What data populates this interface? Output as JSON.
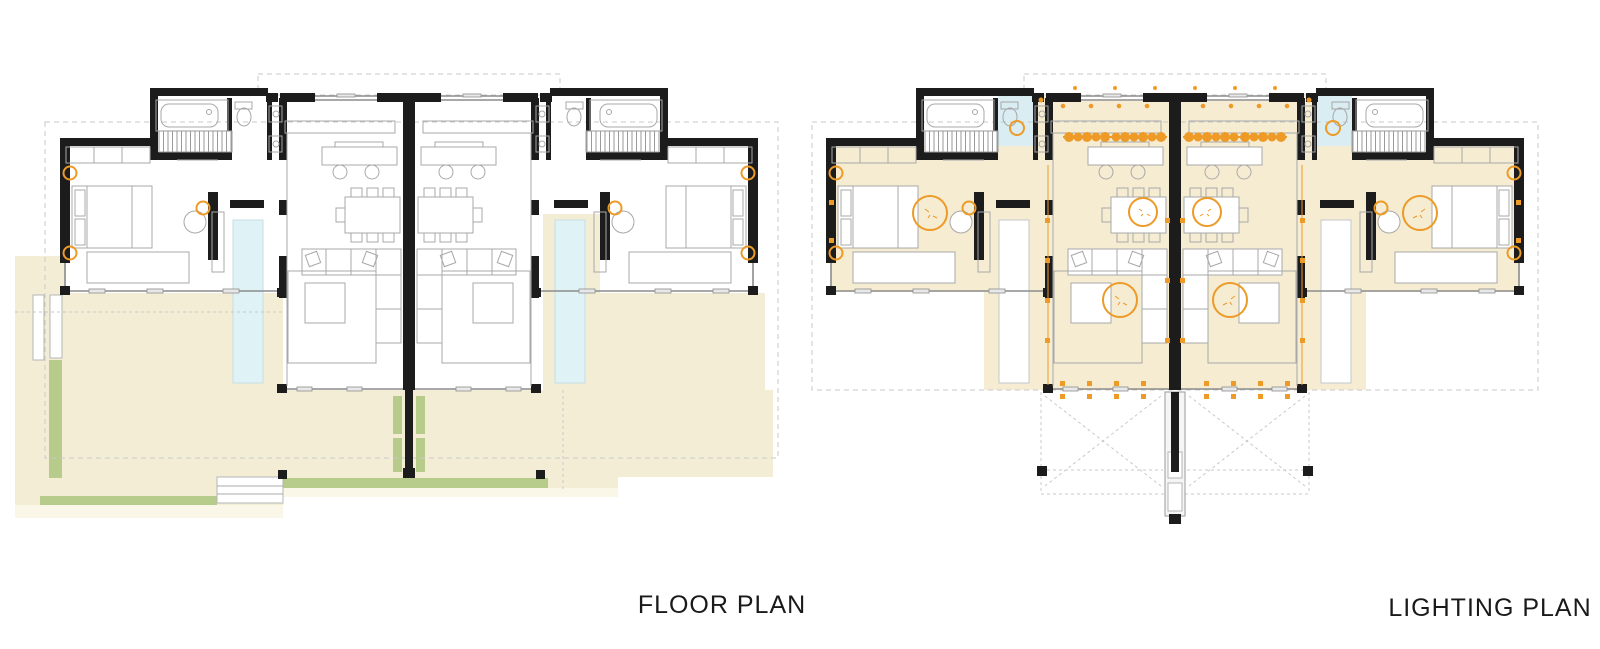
{
  "page": {
    "background": "#ffffff"
  },
  "plans": {
    "floor": {
      "label": "FLOOR PLAN"
    },
    "lighting": {
      "label": "LIGHTING PLAN"
    }
  },
  "symbols": {
    "pendant_row": "kitchen pendant-light row",
    "ceiling_fan": "round ceiling light",
    "wall_light": "orange wall-light circle",
    "spot_marker": "orange spot marker",
    "stair_hatch": "staircase",
    "pool": "lap pool",
    "planting_strip": "planting strip",
    "terrace": "terrace paving"
  },
  "colors": {
    "wall": "#1c1c1c",
    "furniture_line": "#a8a8a8",
    "glass_line": "#8c8c8c",
    "terrace": "#f3edd6",
    "terrace_light": "#faf6e8",
    "planting": "#b7cb8b",
    "pool": "#dff3f6",
    "pool_edge": "#c5dee1",
    "room_tint": "#f5ecd2",
    "bath_tint": "#d9edf2",
    "lighting_orange": "#ee9a26",
    "dashed_line": "#c9c9c9",
    "label_text": "#1a1a1a",
    "walkway": "#f5f5f5",
    "background": "#ffffff"
  }
}
